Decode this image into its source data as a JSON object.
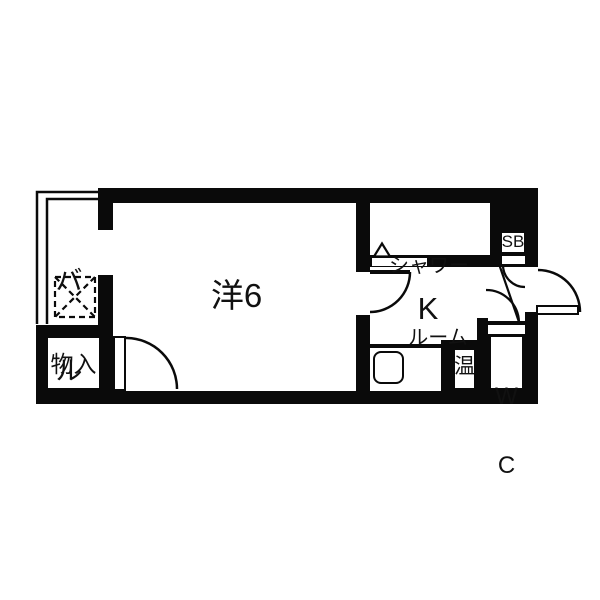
{
  "floorplan": {
    "title": "1R apartment floor plan",
    "colors": {
      "wall": "#0a0a0a",
      "floor": "#ffffff"
    },
    "rooms": {
      "balcony": {
        "name": "balcony",
        "label_chars": [
          "バ",
          "ル"
        ]
      },
      "western_room": {
        "name": "western-room",
        "label": "洋6"
      },
      "storage": {
        "name": "storage",
        "label": "物入"
      },
      "shower_room": {
        "name": "shower-room",
        "label_lines": [
          "シャワー",
          "ルーム"
        ]
      },
      "kitchen": {
        "name": "kitchen",
        "label": "K"
      },
      "shoe_box": {
        "name": "shoe-box",
        "label": "SB"
      },
      "water_heater": {
        "name": "water-heater",
        "label": "温"
      },
      "toilet": {
        "name": "toilet",
        "label_lines": [
          "W",
          "C"
        ]
      }
    }
  }
}
